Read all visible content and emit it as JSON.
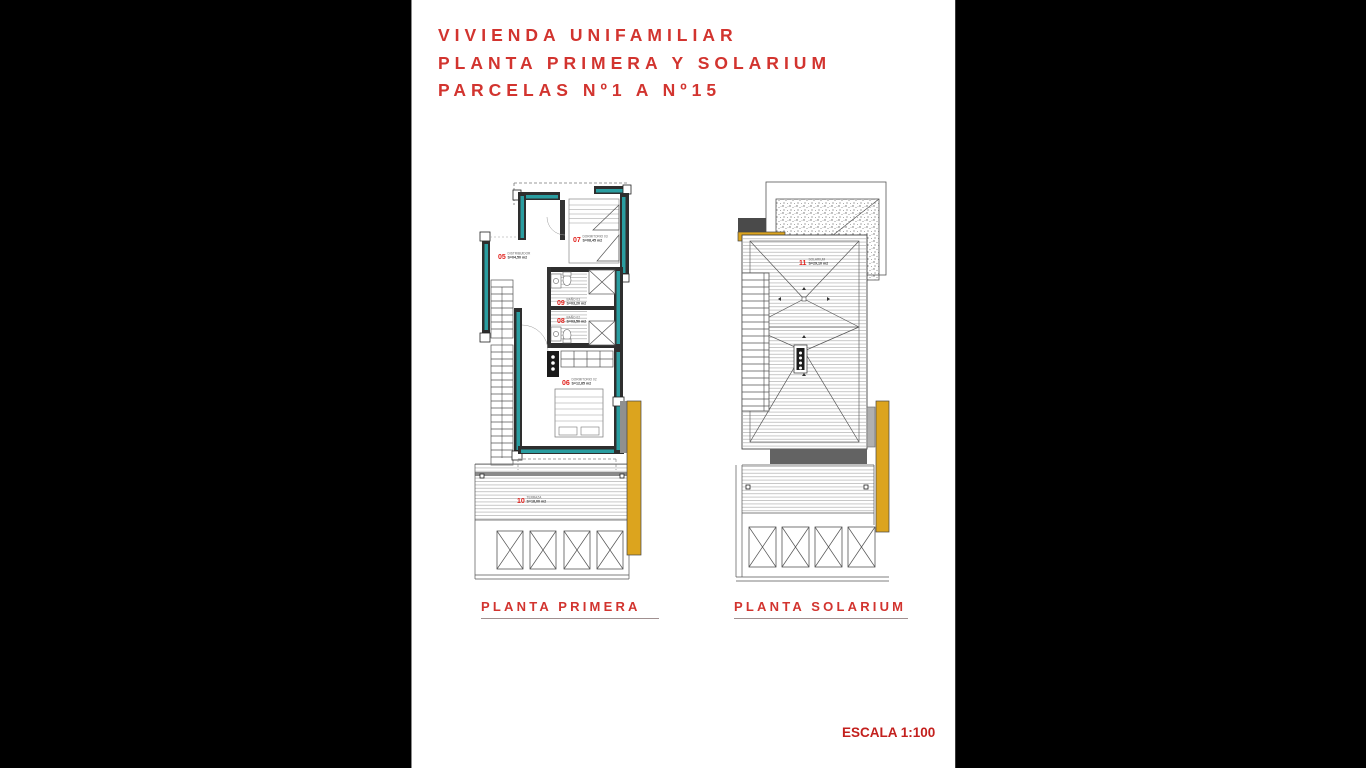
{
  "page": {
    "title_lines": [
      "VIVIENDA UNIFAMILIAR",
      "PLANTA PRIMERA Y SOLARIUM",
      "PARCELAS Nº1 A Nº15"
    ],
    "scale_label": "ESCALA 1:100",
    "colors": {
      "background": "#000000",
      "paper": "#ffffff",
      "accent_red": "#d2342f",
      "label_red": "#e1211c",
      "wall_dark": "#2e2e2e",
      "insulation_teal": "#2a9da0",
      "carpentry_gold": "#dca41e"
    }
  },
  "plans": {
    "primera": {
      "title": "PLANTA PRIMERA",
      "rooms": [
        {
          "num": "05",
          "name": "DISTRIBUIDOR",
          "area": "S=04,50 m2"
        },
        {
          "num": "07",
          "name": "DORMITORIO 03",
          "area": "S=08,45 m2"
        },
        {
          "num": "09",
          "name": "BAÑO 03",
          "area": "S=03,20 m2"
        },
        {
          "num": "08",
          "name": "BAÑO 02",
          "area": "S=03,50 m2"
        },
        {
          "num": "06",
          "name": "DORMITORIO 02",
          "area": "S=12,85 m2"
        },
        {
          "num": "10",
          "name": "TERRAZA",
          "area": "S=18,00 m2"
        }
      ]
    },
    "solarium": {
      "title": "PLANTA SOLARIUM",
      "rooms": [
        {
          "num": "11",
          "name": "SOLARIUM",
          "area": "S=29,10 m2"
        }
      ]
    }
  }
}
